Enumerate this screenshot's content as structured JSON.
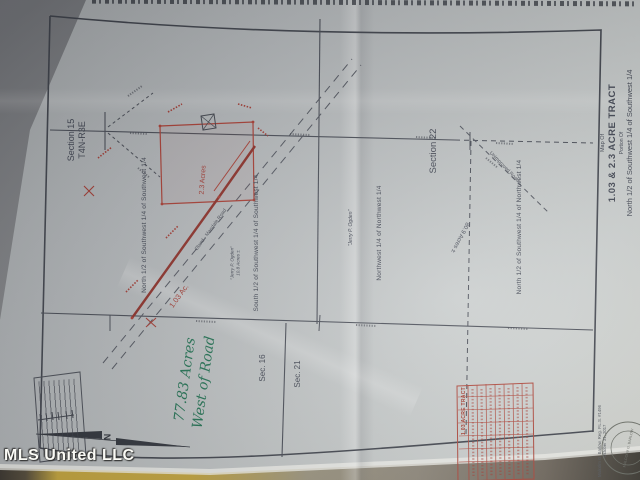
{
  "photo": {
    "watermark": "MLS United LLC"
  },
  "plat": {
    "right_title": {
      "map_of": "Map Of",
      "title": "1.03 & 2.3 ACRE TRACT",
      "portion_of": "Portion Of",
      "description": "North 1/2 of Southwest 1/4 of Southwest 1/4"
    },
    "sections": {
      "section15": "Section 15",
      "township": "T4N-R3E",
      "section22": "Section 22",
      "sec16": "Sec. 16",
      "sec21": "Sec. 21"
    },
    "labels": {
      "n_half_sw_sw": "North 1/2 of Southwest 1/4 of Southwest 1/4",
      "s_half_sw_sw": "South 1/2 of Southwest 1/4 of Southwest 1/4",
      "nw_nw": "Northwest 1/4 of Northwest 1/4",
      "n_half_sw_nw": "North 1/2 of Southwest 1/4 of Northwest 1/4",
      "owner_center": "\"Jerry P. Ogden\"",
      "owner_center_acres": "10.8 Acres ±",
      "owner_right": "\"Jerry P. Ogden\"",
      "acres_80": "80.9 Acres ±",
      "acres_23": "2.3 Acres",
      "acres_103": "1.03 Ac.",
      "road_name": "Oland - Mandale Road",
      "unimproved_road": "Unimproved Road",
      "north_letter": "N"
    },
    "handwriting": {
      "line1": "77.83 Acres",
      "line2": "West of Road"
    },
    "line_table": {
      "title": "1.03 ACRE TRACT"
    },
    "surveyor": {
      "name_line": "Malcolm G. Barlow, Reg. P.L.S. #1496",
      "date_line": "October 31, 2017",
      "seal_name": "MALCOLM G. BARLOW"
    }
  }
}
